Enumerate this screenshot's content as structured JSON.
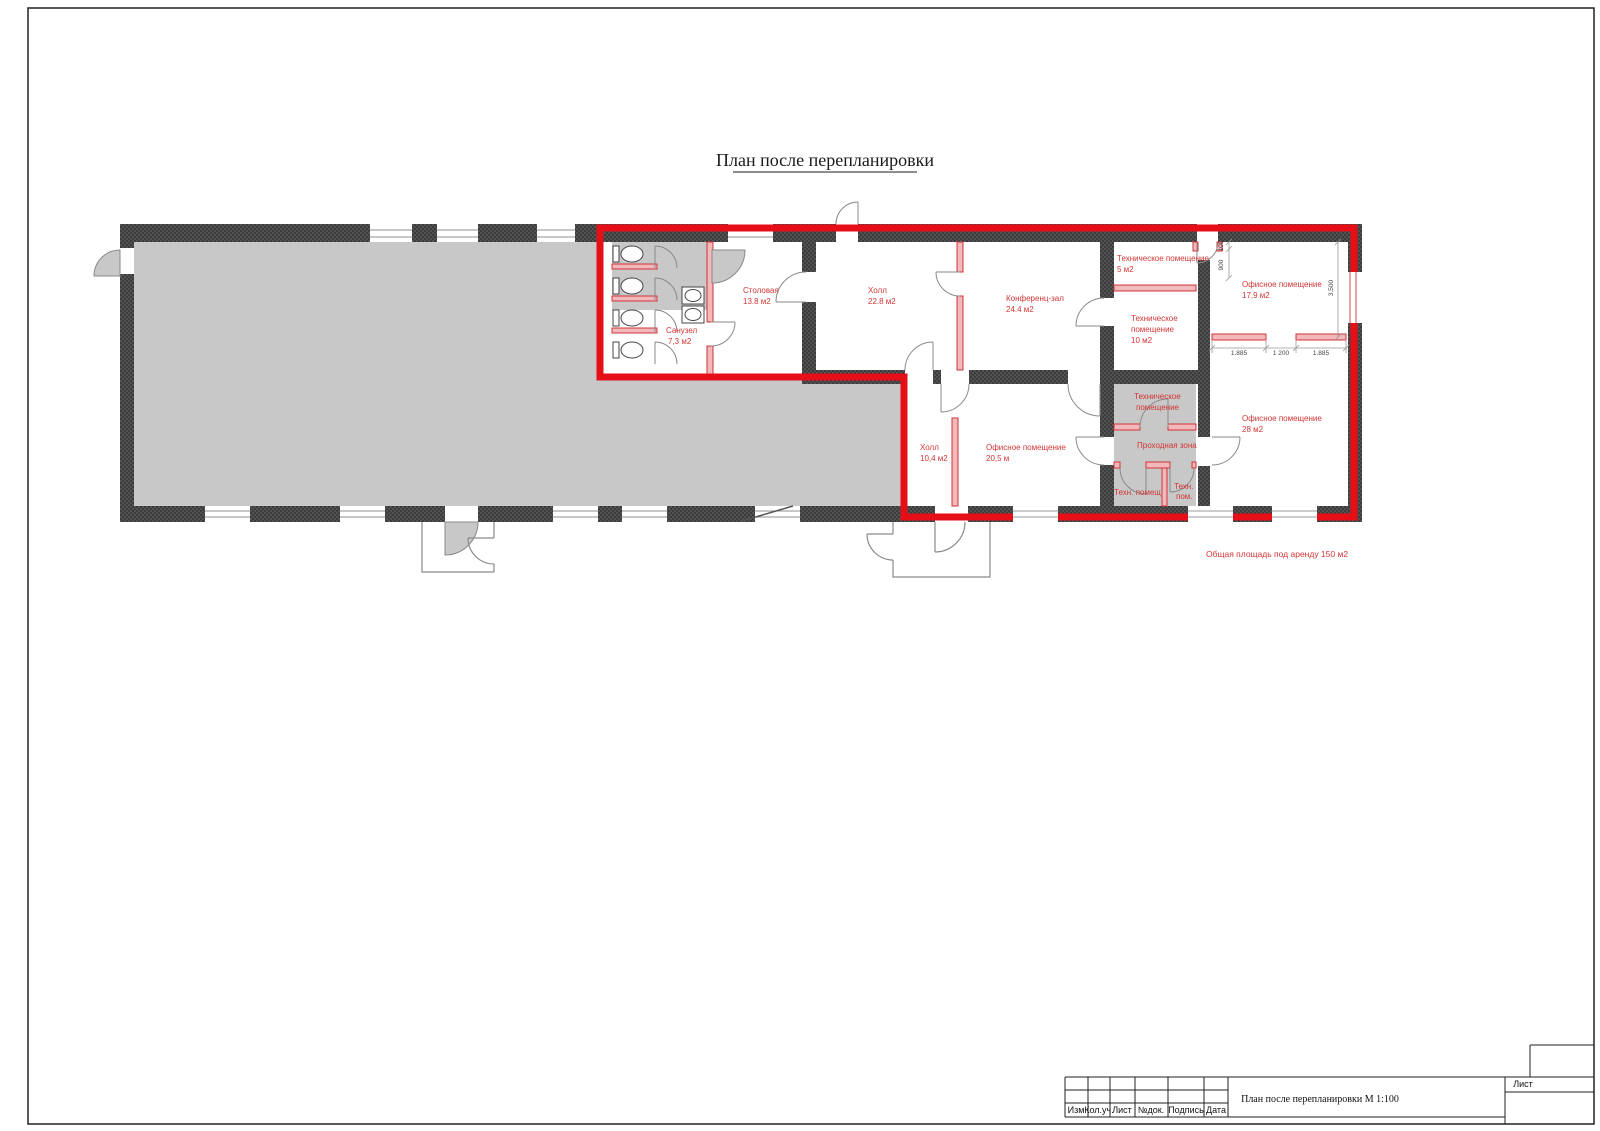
{
  "drawing": {
    "title": "План после перепланировки"
  },
  "plan": {
    "rooms": {
      "sanuzel": {
        "lines": [
          "Санузел",
          "7,3 м2"
        ]
      },
      "stolovaya": {
        "lines": [
          "Столовая",
          "13.8 м2"
        ]
      },
      "hall_top": {
        "lines": [
          "Холл",
          "22.8 м2"
        ]
      },
      "conference": {
        "lines": [
          "Конференц-зал",
          "24.4 м2"
        ]
      },
      "tech5": {
        "lines": [
          "Техническое помещение",
          "5 м2"
        ]
      },
      "tech10": {
        "lines": [
          "Техническое",
          "помещение",
          "10 м2"
        ]
      },
      "office179": {
        "lines": [
          "Офисное помещение",
          "17,9 м2"
        ]
      },
      "hall_bottom": {
        "lines": [
          "Холл",
          "10,4 м2"
        ]
      },
      "office205": {
        "lines": [
          "Офисное помещение",
          "20,5 м"
        ]
      },
      "tech_center": {
        "lines": [
          "Техническое",
          "помещение"
        ]
      },
      "passage": {
        "lines": [
          "Проходная зона"
        ]
      },
      "tech_small_left": {
        "lines": [
          "Техн. помещ"
        ]
      },
      "tech_small_right": {
        "lines": [
          "Техн.",
          "пом."
        ]
      },
      "office28": {
        "lines": [
          "Офисное помещение",
          "28 м2"
        ]
      }
    },
    "dimensions": {
      "left_width": "1.885",
      "opening": "1 200",
      "right_width": "1.885",
      "room_depth": "3.500",
      "door_width": "900",
      "door_offset": "100"
    },
    "total_area_note": "Общая площадь под аренду 150 м2"
  },
  "titleblock": {
    "columns": [
      "Изм",
      "Кол.уч.",
      "Лист",
      "№док.",
      "Подпись",
      "Дата"
    ],
    "doc_title": "План после перепланировки  М 1:100",
    "sheet_label": "Лист"
  },
  "colors": {
    "rent_boundary": "#e60f17",
    "wall": "#3d3d3d",
    "floor_gray": "#c8c8c8",
    "room_label": "#d23535"
  }
}
